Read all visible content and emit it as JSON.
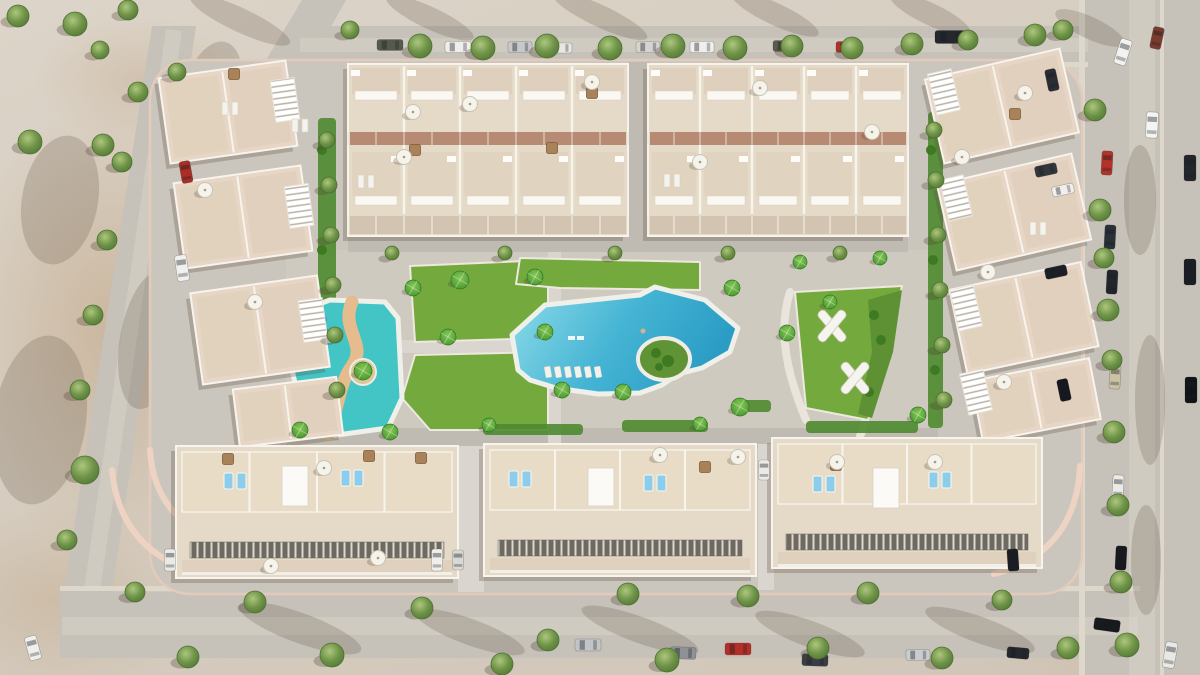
{
  "meta": {
    "label": "Aerial 3D render of a residential complex with swimming pools, lawns and parked cars"
  },
  "palette": {
    "road": "#c6c1b9",
    "sidewalk": "#ddd7cc",
    "worn": "#d8d3c9",
    "complex": "#cbc6bd",
    "court": "#cfcabf",
    "strip": "#bfbab2",
    "path": "#dad6cf",
    "curb": "#eed3c3",
    "lawn": "#74a93e",
    "hedge": "#4e8a2f",
    "garden": "#5d9134",
    "bush": "#3e7a22",
    "roof": "#e5d9c7",
    "roofwarm": "#e7d6c5",
    "wall": "#f7f4ed",
    "innershade": "#d9c9b3",
    "terracotta": "#b78a73",
    "frontstrip": "#cfc0ab",
    "terrace": "#e9dcc7",
    "apron": "#dbccb7",
    "kidspool": "#43c5c5",
    "sandpath": "#e4bc8e",
    "slide": "#2e6fd2",
    "islandgreen": "#5f9335",
    "pooledge": "#eef0e9",
    "lounger": "#8ccdec",
    "whitelounger": "#f5f3ed",
    "umbrella": "#f6f3ea",
    "wood": "#a9825a",
    "shadow": "rgba(88,73,57,0.28)",
    "treeline": "#4e7031"
  },
  "scene": {
    "roads": {
      "rects": [
        [
          300,
          26,
          790,
          38
        ],
        [
          1085,
          0,
          115,
          675
        ],
        [
          60,
          592,
          1080,
          66
        ]
      ],
      "polys": [
        "152,26 196,26 112,592 64,592",
        "302,0 346,0 262,150 218,140"
      ],
      "sidewalks": [
        [
          300,
          62,
          788,
          5
        ],
        [
          60,
          586,
          1080,
          5
        ],
        [
          1079,
          0,
          6,
          675
        ],
        [
          1160,
          0,
          4,
          675
        ]
      ],
      "worn": [
        [
          "M300,45 H1088",
          14
        ],
        [
          "M62,626 H1138",
          18
        ],
        [
          "M1142,0 V675",
          26
        ],
        [
          "M174,30 L92,590",
          16
        ]
      ]
    },
    "blobs": [
      [
        240,
        20,
        55,
        12,
        25
      ],
      [
        430,
        18,
        48,
        11,
        25
      ],
      [
        600,
        16,
        52,
        11,
        25
      ],
      [
        775,
        14,
        48,
        11,
        25
      ],
      [
        930,
        14,
        44,
        11,
        25
      ],
      [
        1090,
        28,
        38,
        11,
        25
      ],
      [
        60,
        200,
        38,
        65,
        10
      ],
      [
        40,
        420,
        46,
        85,
        8
      ],
      [
        300,
        628,
        65,
        15,
        20
      ],
      [
        470,
        632,
        58,
        13,
        20
      ],
      [
        640,
        630,
        62,
        13,
        20
      ],
      [
        810,
        634,
        58,
        13,
        20
      ],
      [
        980,
        630,
        58,
        13,
        20
      ],
      [
        1140,
        200,
        16,
        55,
        0
      ],
      [
        1150,
        400,
        15,
        65,
        0
      ],
      [
        1146,
        560,
        15,
        55,
        0
      ],
      [
        210,
        100,
        30,
        60,
        15
      ],
      [
        150,
        340,
        30,
        70,
        10
      ]
    ],
    "complex": {
      "x": 150,
      "y": 60,
      "w": 932,
      "h": 534,
      "rx": 40,
      "curbs": [
        "M112,470 Q120,556 210,576",
        "M1080,466 Q1076,552 994,574",
        "M150,450 Q154,516 216,540"
      ]
    },
    "courtyard": [
      286,
      250,
      652,
      198
    ],
    "strips": [
      [
        628,
        62,
        22,
        190
      ],
      [
        348,
        236,
        560,
        16
      ],
      [
        286,
        428,
        652,
        20
      ]
    ],
    "paths": {
      "rects": [
        [
          548,
          252,
          13,
          196
        ],
        [
          378,
          340,
          172,
          13
        ],
        [
          458,
          446,
          26,
          146
        ],
        [
          758,
          444,
          16,
          146
        ]
      ],
      "strokes": [
        [
          "M868,292 C850,320 888,340 872,372 C860,396 872,412 860,436",
          8
        ],
        [
          "M790,292 C778,330 786,372 806,420",
          8
        ]
      ]
    },
    "lawns": [
      "410,266 548,260 548,338 415,342",
      "520,258 700,262 700,290 560,288 516,284",
      "415,355 548,352 548,430 430,430 402,398",
      "795,292 902,286 888,352 868,420 806,408",
      "270,315 287,310 284,347 268,341"
    ],
    "gardens": [
      "868,300 902,290 893,352 872,418 858,414 872,352",
      "276,300 292,294 286,352 272,344"
    ],
    "hedges": [
      [
        483,
        424,
        100,
        11
      ],
      [
        622,
        420,
        86,
        12
      ],
      [
        806,
        421,
        112,
        12
      ],
      [
        737,
        400,
        34,
        12
      ],
      [
        318,
        118,
        18,
        296
      ],
      [
        928,
        112,
        15,
        316
      ]
    ],
    "bushes": [
      [
        874,
        315,
        5
      ],
      [
        881,
        340,
        5
      ],
      [
        869,
        392,
        5
      ],
      [
        281,
        312,
        4
      ],
      [
        279,
        336,
        4
      ],
      [
        322,
        150,
        5
      ],
      [
        322,
        250,
        5
      ],
      [
        324,
        350,
        5
      ],
      [
        931,
        150,
        5
      ],
      [
        933,
        260,
        5
      ],
      [
        935,
        370,
        5
      ]
    ],
    "kidsPool": {
      "pts": "298,312 330,300 385,302 398,318 402,398 388,428 330,436 305,425 292,370",
      "sand": "M352,302 C340,330 368,344 352,366 C338,386 340,404 328,434",
      "island": [
        363,
        372,
        13
      ],
      "slide": [
        325,
        331
      ]
    },
    "mainPool": {
      "pts": "518,370 512,335 545,305 640,295 655,287 705,300 738,328 730,352 702,368 678,374 662,385 640,393 598,394 556,388 530,380",
      "island": [
        664,
        359,
        26,
        21
      ],
      "islandBushes": [
        [
          656,
          353,
          5
        ],
        [
          668,
          361,
          6
        ],
        [
          659,
          367,
          4
        ]
      ],
      "shelf": [
        [
          568,
          336
        ],
        [
          577,
          336
        ]
      ],
      "swimmer": [
        643,
        331
      ],
      "rowX": 548,
      "rowY": 372,
      "rowN": 6,
      "rowStep": 10
    },
    "topBlocks": [
      {
        "x": 348,
        "y": 64,
        "w": 280,
        "h": 172,
        "units": 5
      },
      {
        "x": 648,
        "y": 64,
        "w": 260,
        "h": 172,
        "units": 5
      }
    ],
    "sideBuildings": [
      {
        "cx": 228,
        "cy": 112,
        "w": 128,
        "h": 86,
        "rot": -8
      },
      {
        "cx": 243,
        "cy": 217,
        "w": 128,
        "h": 86,
        "rot": -8
      },
      {
        "cx": 260,
        "cy": 330,
        "w": 128,
        "h": 92,
        "rot": -8
      },
      {
        "cx": 288,
        "cy": 412,
        "w": 104,
        "h": 58,
        "rot": -7
      },
      {
        "cx": 1002,
        "cy": 106,
        "w": 138,
        "h": 86,
        "rot": -13
      },
      {
        "cx": 1014,
        "cy": 212,
        "w": 138,
        "h": 88,
        "rot": -13
      },
      {
        "cx": 1024,
        "cy": 318,
        "w": 134,
        "h": 86,
        "rot": -12
      },
      {
        "cx": 1036,
        "cy": 400,
        "w": 120,
        "h": 62,
        "rot": -11
      }
    ],
    "bottomBlocks": [
      {
        "x": 176,
        "y": 446,
        "w": 282,
        "h": 132
      },
      {
        "x": 484,
        "y": 444,
        "w": 272,
        "h": 132
      },
      {
        "x": 772,
        "y": 438,
        "w": 270,
        "h": 130
      }
    ],
    "pergolas": [
      [
        285,
        100,
        -8
      ],
      [
        299,
        206,
        -8
      ],
      [
        313,
        320,
        -8
      ],
      [
        944,
        92,
        -13
      ],
      [
        956,
        198,
        -13
      ],
      [
        966,
        308,
        -13
      ],
      [
        976,
        392,
        -13
      ]
    ],
    "whiteBoxes": [
      [
        282,
        466,
        26,
        40
      ],
      [
        588,
        468,
        26,
        38
      ],
      [
        873,
        468,
        26,
        40
      ]
    ],
    "playX": [
      [
        832,
        326
      ],
      [
        855,
        378
      ]
    ],
    "wood": [
      [
        228,
        459
      ],
      [
        369,
        456
      ],
      [
        421,
        458
      ],
      [
        836,
        465
      ],
      [
        592,
        93
      ],
      [
        415,
        150
      ],
      [
        552,
        148
      ],
      [
        1015,
        114
      ],
      [
        234,
        74
      ],
      [
        705,
        467
      ]
    ],
    "loungersBlue": [
      [
        235,
        481
      ],
      [
        352,
        478
      ],
      [
        520,
        479
      ],
      [
        655,
        483
      ],
      [
        824,
        484
      ],
      [
        940,
        480
      ]
    ],
    "loungersWhite": [
      [
        366,
        181
      ],
      [
        230,
        108
      ],
      [
        1038,
        228
      ],
      [
        672,
        180
      ],
      [
        300,
        125
      ]
    ],
    "umbrellas": [
      [
        413,
        112
      ],
      [
        470,
        104
      ],
      [
        592,
        82
      ],
      [
        404,
        157
      ],
      [
        760,
        88
      ],
      [
        700,
        162
      ],
      [
        872,
        132
      ],
      [
        324,
        468
      ],
      [
        271,
        566
      ],
      [
        660,
        455
      ],
      [
        738,
        457
      ],
      [
        837,
        462
      ],
      [
        935,
        462
      ],
      [
        205,
        190
      ],
      [
        255,
        302
      ],
      [
        1025,
        93
      ],
      [
        962,
        157
      ],
      [
        988,
        272
      ],
      [
        1004,
        382
      ],
      [
        378,
        558
      ]
    ],
    "cars": [
      [
        390,
        45,
        26,
        11,
        0,
        "#565a4b"
      ],
      [
        458,
        47,
        26,
        11,
        0,
        "#efeeea"
      ],
      [
        520,
        47,
        24,
        11,
        0,
        "#c7c8ca"
      ],
      [
        561,
        48,
        22,
        10,
        0,
        "#e8e7e3"
      ],
      [
        648,
        47,
        24,
        11,
        0,
        "#d5d4d0"
      ],
      [
        702,
        47,
        24,
        11,
        0,
        "#f0efec"
      ],
      [
        786,
        46,
        26,
        11,
        0,
        "#5a5d4e"
      ],
      [
        848,
        47,
        24,
        11,
        0,
        "#b23028"
      ],
      [
        950,
        37,
        30,
        13,
        0,
        "#24272b"
      ],
      [
        1123,
        52,
        12,
        26,
        18,
        "#f2f2f0"
      ],
      [
        1157,
        38,
        11,
        22,
        12,
        "#7a3b2e"
      ],
      [
        1152,
        125,
        12,
        26,
        3,
        "#f4f4f2"
      ],
      [
        1107,
        163,
        11,
        24,
        3,
        "#b2332a"
      ],
      [
        1110,
        237,
        11,
        24,
        3,
        "#2a3038"
      ],
      [
        1112,
        282,
        11,
        24,
        3,
        "#22262c"
      ],
      [
        1115,
        377,
        11,
        24,
        3,
        "#cbc2a4"
      ],
      [
        1118,
        487,
        11,
        24,
        3,
        "#eceae6"
      ],
      [
        1121,
        558,
        11,
        24,
        3,
        "#17191e"
      ],
      [
        1190,
        168,
        12,
        26,
        0,
        "#23262b"
      ],
      [
        1190,
        272,
        12,
        26,
        0,
        "#1b1e23"
      ],
      [
        1191,
        390,
        12,
        26,
        0,
        "#101317"
      ],
      [
        1170,
        655,
        12,
        26,
        10,
        "#e8e8e6"
      ],
      [
        1107,
        625,
        26,
        12,
        8,
        "#17191d"
      ],
      [
        1052,
        80,
        11,
        22,
        -12,
        "#2a2d33"
      ],
      [
        1046,
        170,
        22,
        11,
        -12,
        "#33363c"
      ],
      [
        1063,
        190,
        22,
        10,
        -12,
        "#f0efec"
      ],
      [
        1056,
        272,
        22,
        11,
        -12,
        "#1c2026"
      ],
      [
        1064,
        390,
        11,
        22,
        -12,
        "#15181d"
      ],
      [
        186,
        172,
        11,
        22,
        -10,
        "#a82e26"
      ],
      [
        182,
        268,
        12,
        26,
        -8,
        "#f1f0ee"
      ],
      [
        33,
        648,
        12,
        24,
        -15,
        "#f0efed"
      ],
      [
        588,
        645,
        26,
        12,
        0,
        "#c2c4c6"
      ],
      [
        683,
        653,
        26,
        12,
        2,
        "#8e9296"
      ],
      [
        738,
        649,
        26,
        12,
        0,
        "#b42f27"
      ],
      [
        815,
        660,
        26,
        12,
        2,
        "#3a3e44"
      ],
      [
        918,
        655,
        24,
        11,
        0,
        "#caccce"
      ],
      [
        170,
        560,
        11,
        22,
        0,
        "#eceae7"
      ],
      [
        437,
        560,
        11,
        22,
        0,
        "#f0efec"
      ],
      [
        458,
        560,
        11,
        20,
        0,
        "#d9d8d4"
      ],
      [
        764,
        470,
        11,
        20,
        0,
        "#eceae7"
      ],
      [
        1013,
        560,
        11,
        22,
        -4,
        "#1a1d22"
      ],
      [
        1018,
        653,
        22,
        11,
        5,
        "#24272c"
      ]
    ],
    "trees": [
      [
        18,
        16,
        11
      ],
      [
        75,
        24,
        12
      ],
      [
        128,
        10,
        10
      ],
      [
        100,
        50,
        9
      ],
      [
        30,
        142,
        12
      ],
      [
        103,
        145,
        11
      ],
      [
        177,
        72,
        9
      ],
      [
        138,
        92,
        10
      ],
      [
        122,
        162,
        10
      ],
      [
        107,
        240,
        10
      ],
      [
        93,
        315,
        10
      ],
      [
        80,
        390,
        10
      ],
      [
        85,
        470,
        14
      ],
      [
        67,
        540,
        10
      ],
      [
        135,
        592,
        10
      ],
      [
        188,
        657,
        11
      ],
      [
        350,
        30,
        9
      ],
      [
        420,
        46,
        12
      ],
      [
        483,
        48,
        12
      ],
      [
        547,
        46,
        12
      ],
      [
        610,
        48,
        12
      ],
      [
        673,
        46,
        12
      ],
      [
        735,
        48,
        12
      ],
      [
        792,
        46,
        11
      ],
      [
        852,
        48,
        11
      ],
      [
        912,
        44,
        11
      ],
      [
        968,
        40,
        10
      ],
      [
        1035,
        35,
        11
      ],
      [
        1063,
        30,
        10
      ],
      [
        1095,
        110,
        11
      ],
      [
        1100,
        210,
        11
      ],
      [
        1104,
        258,
        10
      ],
      [
        1108,
        310,
        11
      ],
      [
        1112,
        360,
        10
      ],
      [
        1114,
        432,
        11
      ],
      [
        1118,
        505,
        11
      ],
      [
        1121,
        582,
        11
      ],
      [
        1127,
        645,
        12
      ],
      [
        255,
        602,
        11
      ],
      [
        332,
        655,
        12
      ],
      [
        422,
        608,
        11
      ],
      [
        502,
        664,
        11
      ],
      [
        548,
        640,
        11
      ],
      [
        628,
        594,
        11
      ],
      [
        667,
        660,
        12
      ],
      [
        748,
        596,
        11
      ],
      [
        818,
        648,
        11
      ],
      [
        868,
        593,
        11
      ],
      [
        942,
        658,
        11
      ],
      [
        1002,
        600,
        10
      ],
      [
        1068,
        648,
        11
      ],
      [
        392,
        253,
        7
      ],
      [
        505,
        253,
        7
      ],
      [
        615,
        253,
        7
      ],
      [
        728,
        253,
        7
      ],
      [
        840,
        253,
        7
      ],
      [
        327,
        140,
        8
      ],
      [
        329,
        185,
        8
      ],
      [
        331,
        235,
        8
      ],
      [
        333,
        285,
        8
      ],
      [
        335,
        335,
        8
      ],
      [
        337,
        390,
        8
      ],
      [
        934,
        130,
        8
      ],
      [
        936,
        180,
        8
      ],
      [
        938,
        235,
        8
      ],
      [
        940,
        290,
        8
      ],
      [
        942,
        345,
        8
      ],
      [
        944,
        400,
        8
      ]
    ],
    "palms": [
      [
        413,
        288,
        8
      ],
      [
        460,
        280,
        9
      ],
      [
        535,
        277,
        8
      ],
      [
        448,
        337,
        8
      ],
      [
        545,
        332,
        8
      ],
      [
        562,
        390,
        8
      ],
      [
        623,
        392,
        8
      ],
      [
        740,
        407,
        9
      ],
      [
        732,
        288,
        8
      ],
      [
        787,
        333,
        8
      ],
      [
        363,
        371,
        9
      ],
      [
        300,
        430,
        8
      ],
      [
        390,
        432,
        8
      ],
      [
        830,
        302,
        7
      ],
      [
        800,
        262,
        7
      ],
      [
        880,
        258,
        7
      ],
      [
        918,
        415,
        8
      ],
      [
        489,
        425,
        7
      ],
      [
        700,
        424,
        7
      ]
    ]
  }
}
